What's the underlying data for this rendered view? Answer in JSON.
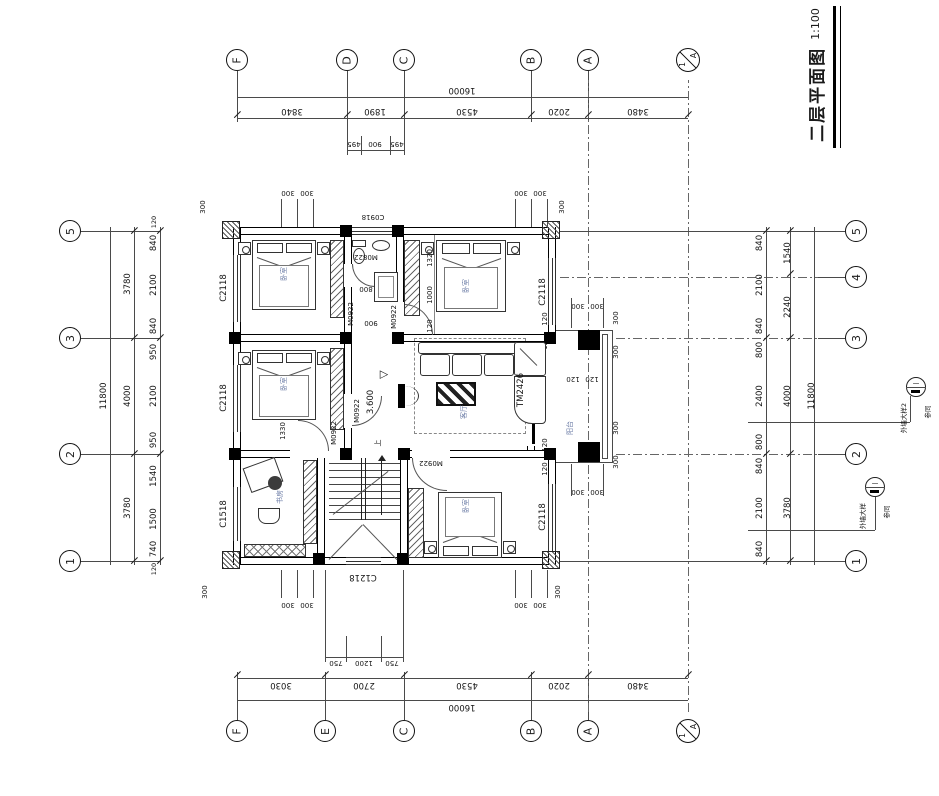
{
  "title": {
    "name": "二层平面图",
    "scale": "1:100"
  },
  "axis": {
    "top": [
      "F",
      "D",
      "C",
      "B",
      "A"
    ],
    "bottom": [
      "F",
      "E",
      "C",
      "B",
      "A"
    ],
    "left": [
      "5",
      "3",
      "2",
      "1"
    ],
    "right": [
      "5",
      "4",
      "3",
      "2",
      "1"
    ],
    "extra": {
      "num": "1",
      "letter": "A"
    }
  },
  "dim": {
    "top": {
      "total": "16000",
      "seg": [
        "3840",
        "1890",
        "4530",
        "2020",
        "3480"
      ],
      "sub": [
        "495",
        "900",
        "495"
      ],
      "off": [
        "300",
        "300",
        "300",
        "300",
        "300",
        "300"
      ]
    },
    "bottom": {
      "total": "16000",
      "seg": [
        "3030",
        "2700",
        "4530",
        "2020",
        "3480"
      ],
      "sub": [
        "750",
        "1200",
        "750"
      ],
      "off": [
        "300",
        "300",
        "300",
        "300",
        "300",
        "300"
      ]
    },
    "left": {
      "total": "11800",
      "mid": [
        "3780",
        "4000",
        "3780"
      ],
      "seg": [
        "840",
        "2100",
        "840",
        "950",
        "2100",
        "950",
        "1540",
        "1500",
        "740"
      ],
      "end": [
        "120",
        "120"
      ]
    },
    "right": {
      "total": "11800",
      "mid": [
        "1540",
        "2240",
        "4000",
        "3780"
      ],
      "seg": [
        "840",
        "2100",
        "840",
        "800",
        "2400",
        "800",
        "840",
        "2100",
        "840"
      ],
      "b300": [
        "300",
        "300",
        "300",
        "300",
        "300",
        "300",
        "300",
        "300"
      ],
      "b120": [
        "120",
        "120",
        "120",
        "120",
        "120",
        "120"
      ]
    },
    "inner": {
      "tr": [
        "1320",
        "1000",
        "120"
      ],
      "bath": [
        "800",
        "900"
      ],
      "study": "1330"
    }
  },
  "rooms": {
    "bedroom": "卧室",
    "study": "书房",
    "living": "客厅",
    "balcony": "阳台",
    "up": "上",
    "level": "3.600"
  },
  "openings": {
    "c2118": "C2118",
    "c1518": "C1518",
    "c0918": "C0918",
    "c1218": "C1218",
    "m0922": "M0922",
    "m0822": "M0822",
    "tm2426": "TM2426"
  },
  "callouts": {
    "c1": {
      "label": "外墙大样2",
      "ref": "参同",
      "mark": "一"
    },
    "c2": {
      "label": "外墙大样",
      "ref": "参同",
      "mark": "一"
    }
  },
  "symbols": {
    "level_triangle": "▷",
    "up_arrow": "↑"
  }
}
